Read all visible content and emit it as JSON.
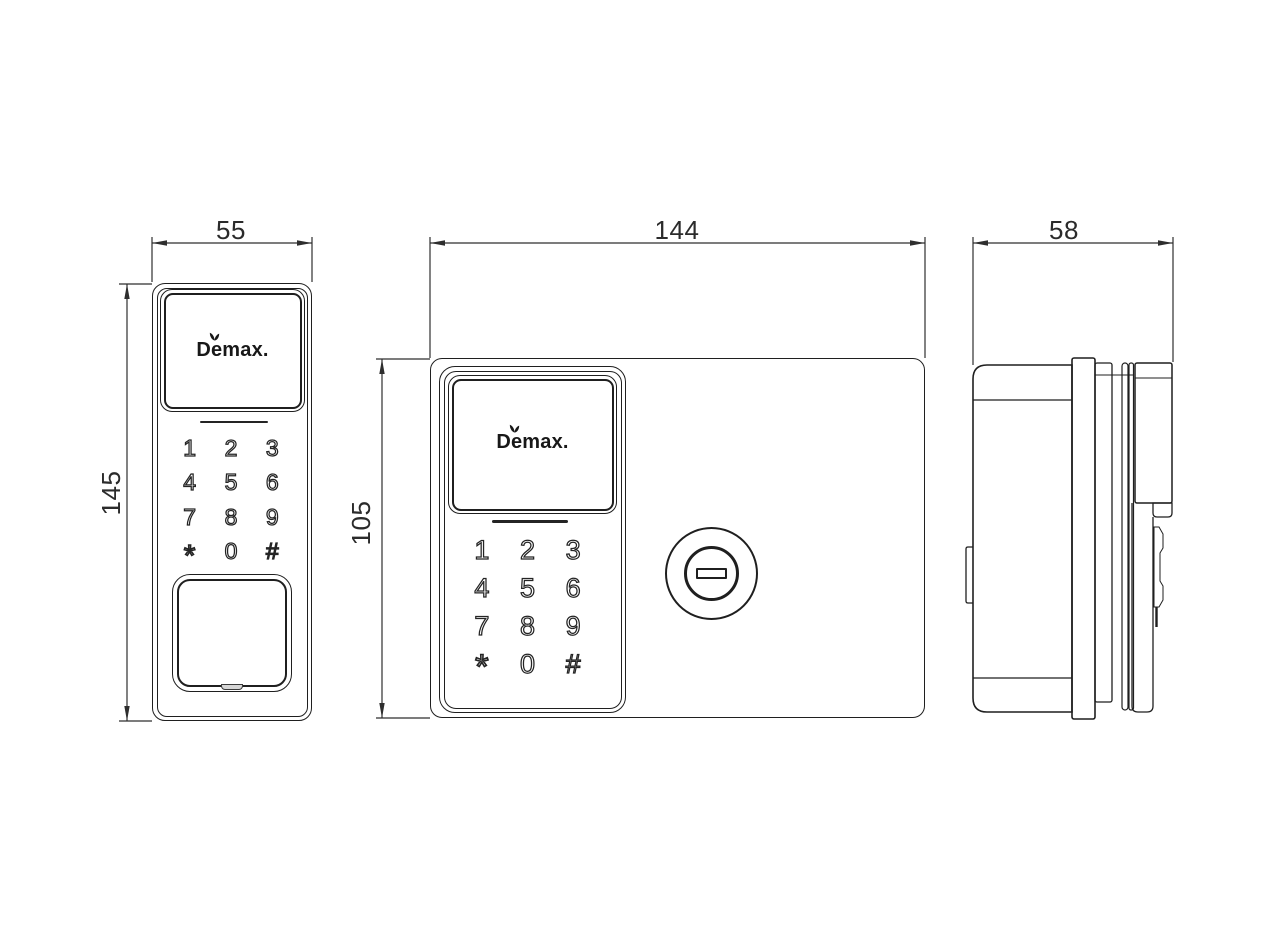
{
  "brand": "Demax.",
  "dimensions": {
    "exterior_unit_width": "55",
    "exterior_unit_height": "145",
    "interior_unit_width": "144",
    "interior_unit_height": "105",
    "side_depth": "58"
  },
  "keypad": {
    "keys": [
      "1",
      "2",
      "3",
      "4",
      "5",
      "6",
      "7",
      "8",
      "9",
      "*",
      "0",
      "#"
    ]
  },
  "colors": {
    "line_ink": "#1f1f1f",
    "dimension_text": "#2b2b2b",
    "background": "#ffffff"
  }
}
